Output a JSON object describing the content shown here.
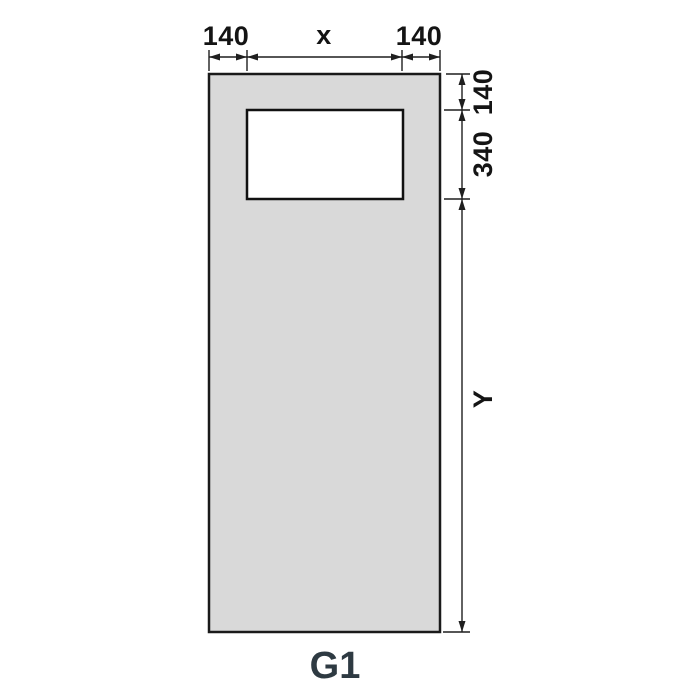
{
  "diagram": {
    "title": "G1",
    "dimensions": {
      "top_left": "140",
      "top_center": "x",
      "top_right": "140",
      "right_top": "140",
      "right_middle": "340",
      "right_bottom": "Y"
    }
  },
  "colors": {
    "panel_fill": "#d9d9d9",
    "outline": "#1a1a1a",
    "dimension": "#1f1f1f",
    "label": "#141414",
    "title": "#2e3a42",
    "background": "#ffffff"
  }
}
